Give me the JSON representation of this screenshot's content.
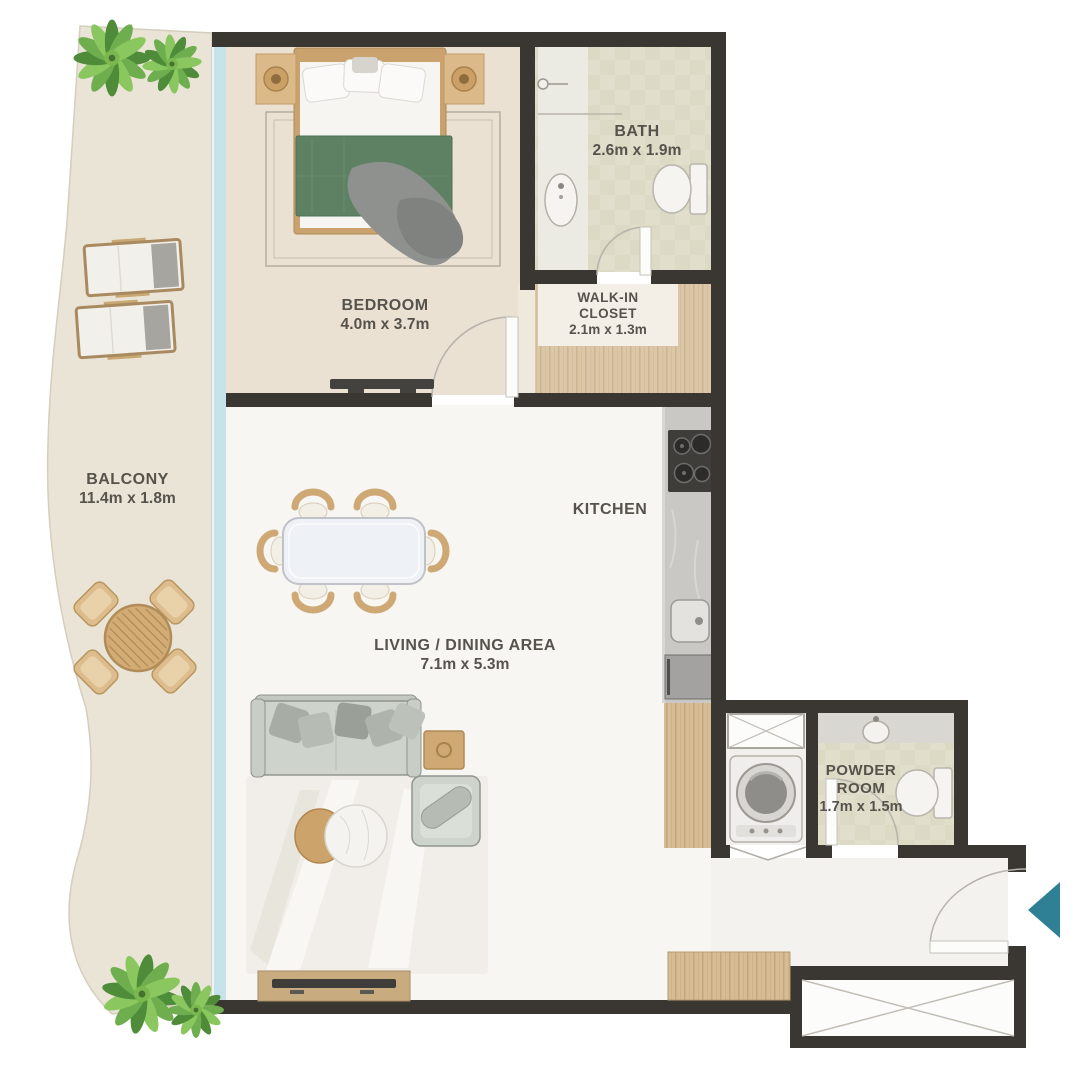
{
  "rooms": {
    "balcony": {
      "name": "BALCONY",
      "dimensions": "11.4m x 1.8m"
    },
    "bedroom": {
      "name": "BEDROOM",
      "dimensions": "4.0m x 3.7m"
    },
    "bath": {
      "name": "BATH",
      "dimensions": "2.6m x 1.9m"
    },
    "walk_in_closet": {
      "name_line1": "WALK-IN",
      "name_line2": "CLOSET",
      "dimensions": "2.1m x 1.3m"
    },
    "kitchen": {
      "name": "KITCHEN"
    },
    "living_dining": {
      "name": "LIVING /  DINING AREA",
      "dimensions": "7.1m x 5.3m"
    },
    "powder_room": {
      "name_line1": "POWDER",
      "name_line2": "ROOM",
      "dimensions": "1.7m x 1.5m"
    }
  },
  "colors": {
    "wall": "#3a3733",
    "glass_wall": "#c6e3ea",
    "balcony_floor": "#e9e4d6",
    "bedroom_floor": "#eae1d3",
    "bath_floor": "#e0ddca",
    "closet_wood": "#dbc7a7",
    "living_floor": "#f7f6f3",
    "kitchen_counter": "#c9c8c4",
    "entrance_arrow": "#2f7f95",
    "bed_blanket": "#5d8162",
    "plant_green": "#6fae4e",
    "label_text": "#56524c"
  },
  "furniture": {
    "balcony": [
      "plant",
      "sun-lounger",
      "sun-lounger",
      "round-table-with-4-chairs",
      "plant"
    ],
    "bedroom": [
      "double-bed",
      "nightstand",
      "nightstand",
      "rug",
      "tv-console"
    ],
    "bath": [
      "shower",
      "vanity-sink",
      "toilet"
    ],
    "walk_in_closet": [
      "wardrobe-floor"
    ],
    "kitchen": [
      "cooktop",
      "sink",
      "refrigerator",
      "tall-cabinet"
    ],
    "living_dining": [
      "dining-table-6-chairs",
      "sofa",
      "side-table",
      "armchair",
      "coffee-tables",
      "area-rug",
      "tv-console",
      "wardrobe"
    ],
    "utility": [
      "storage-cabinet",
      "washing-machine",
      "bifold-doors"
    ],
    "powder_room": [
      "counter-sink",
      "toilet"
    ],
    "entry": [
      "entrance-door",
      "entrance-arrow",
      "storage-closet"
    ]
  }
}
